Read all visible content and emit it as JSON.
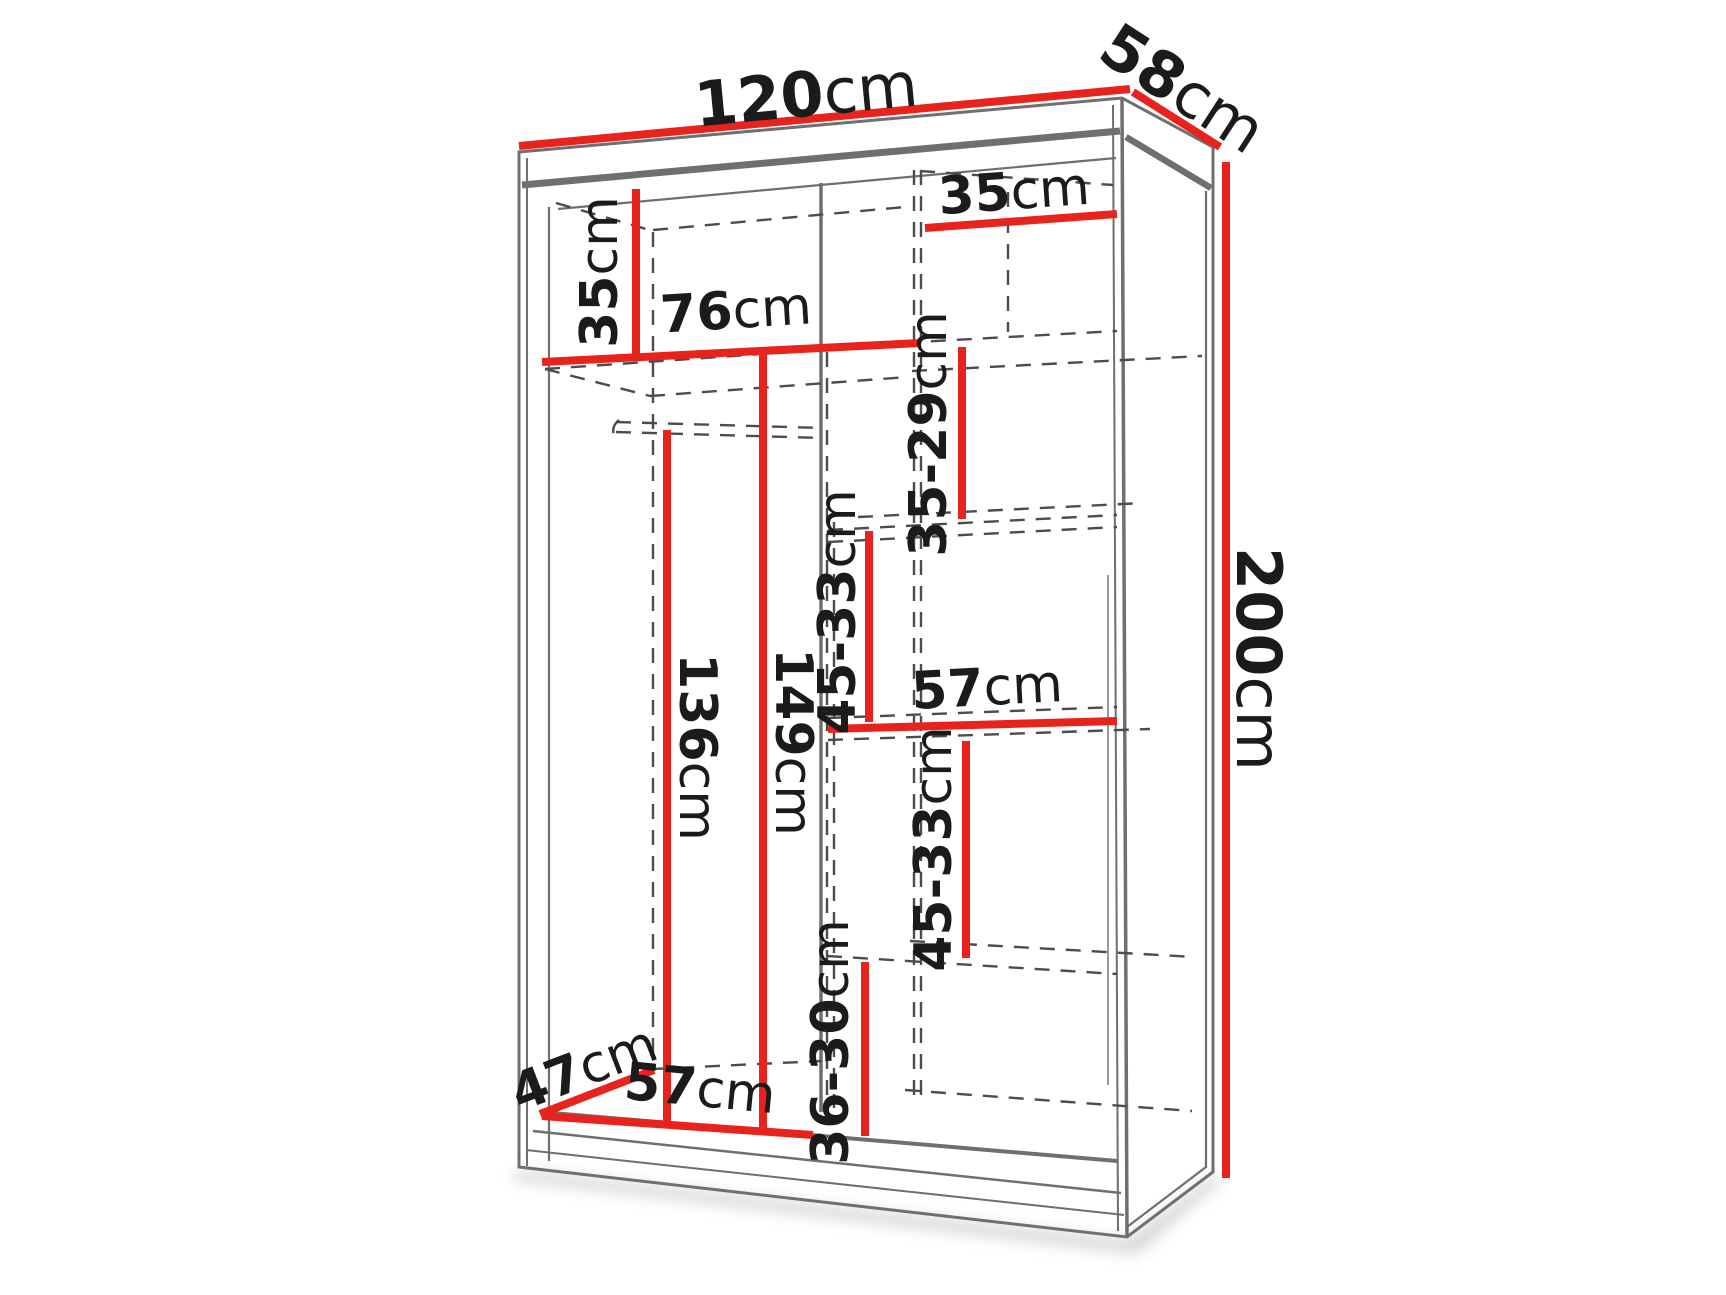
{
  "diagram": {
    "title": "wardrobe-dimension-diagram",
    "colors": {
      "dimension_line": "#e8231e",
      "outline_gray": "#6f6f6f",
      "dashed_gray": "#4c4c4c",
      "text": "#1b1b1b",
      "background": "#ffffff"
    },
    "dimensions": {
      "width_top": {
        "num": "120",
        "unit": "cm"
      },
      "depth_top": {
        "num": "58",
        "unit": "cm"
      },
      "height_right": {
        "num": "200",
        "unit": "cm"
      },
      "left_top_shelf_height": {
        "num": "35",
        "unit": "cm"
      },
      "left_section_width": {
        "num": "76",
        "unit": "cm"
      },
      "right_top_width": {
        "num": "35",
        "unit": "cm"
      },
      "right_gap_top": {
        "num": "35-29",
        "unit": "cm"
      },
      "middle_gap_upper": {
        "num": "45-33",
        "unit": "cm"
      },
      "hanging_height_inner": {
        "num": "136",
        "unit": "cm"
      },
      "hanging_height_outer": {
        "num": "149",
        "unit": "cm"
      },
      "right_mid_width": {
        "num": "57",
        "unit": "cm"
      },
      "right_gap_lower": {
        "num": "45-33",
        "unit": "cm"
      },
      "bottom_depth": {
        "num": "47",
        "unit": "cm"
      },
      "bottom_width": {
        "num": "57",
        "unit": "cm"
      },
      "bottom_gap": {
        "num": "36-30",
        "unit": "cm"
      }
    }
  }
}
